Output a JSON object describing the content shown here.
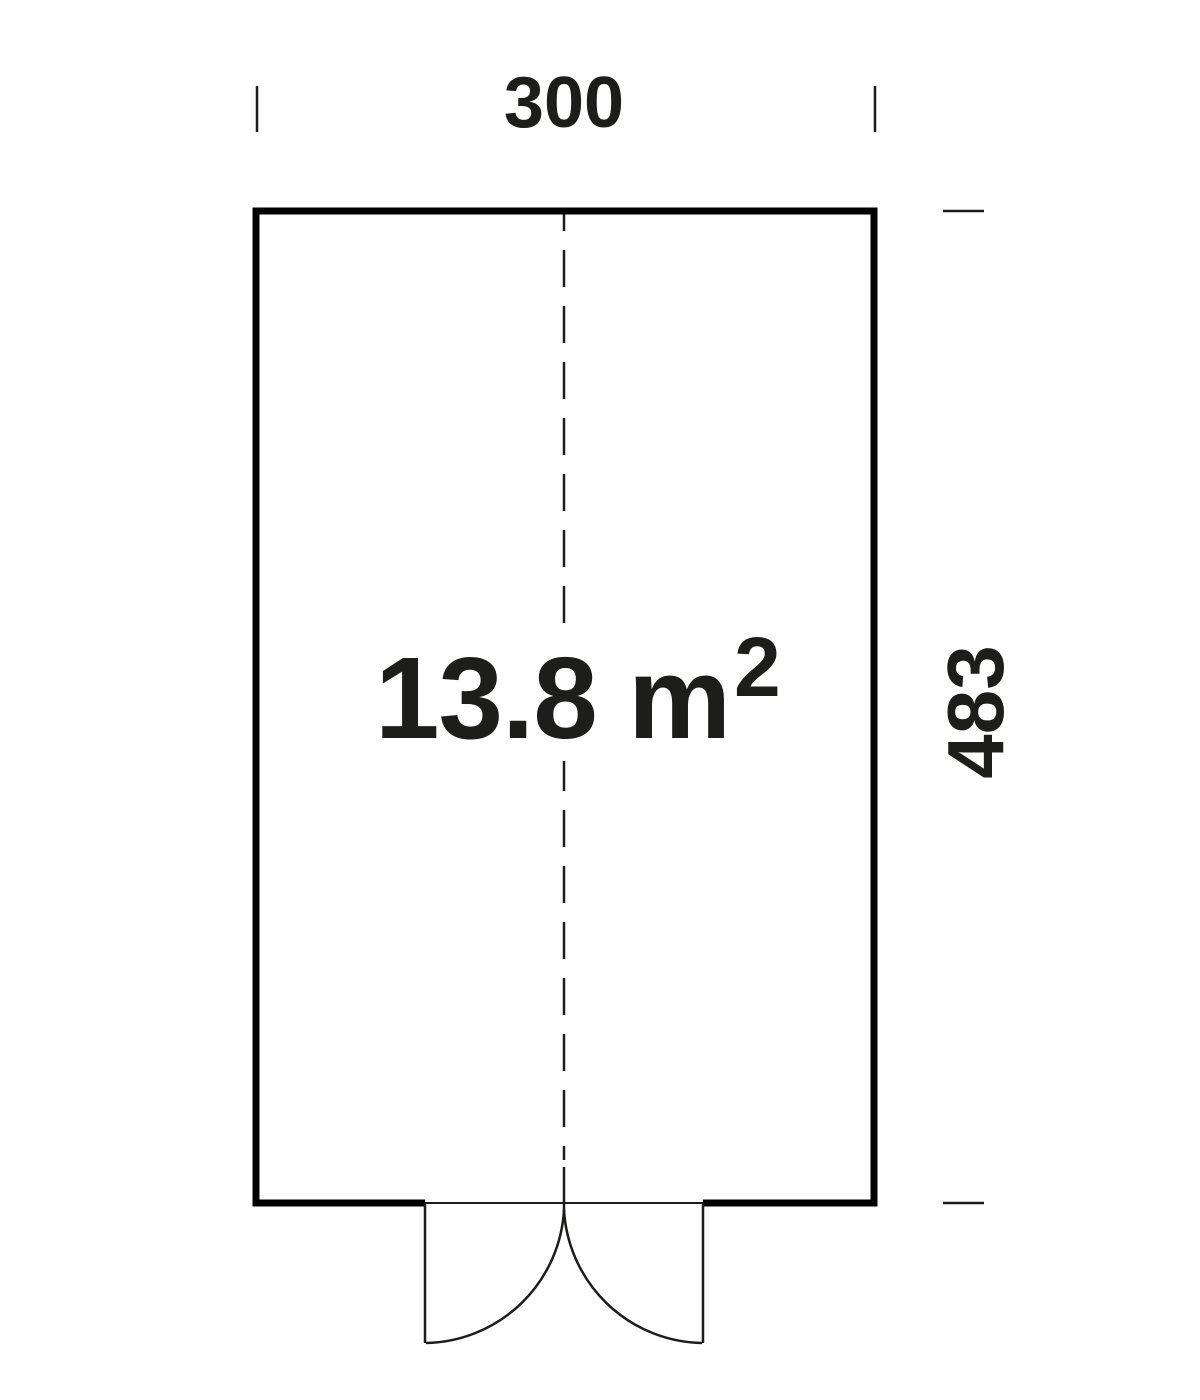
{
  "colors": {
    "ink": "#1d1d1b",
    "line": "#000000",
    "background": "#ffffff"
  },
  "floor_plan": {
    "type_note": "rectangular floor plan with centered double door at bottom",
    "area_label": {
      "value_and_unit": "13.8 m",
      "exponent": "2",
      "full_text": "13.8 m²"
    },
    "width_dimension": {
      "label": "300",
      "position": "top"
    },
    "height_dimension": {
      "label": "483",
      "position": "right"
    }
  }
}
